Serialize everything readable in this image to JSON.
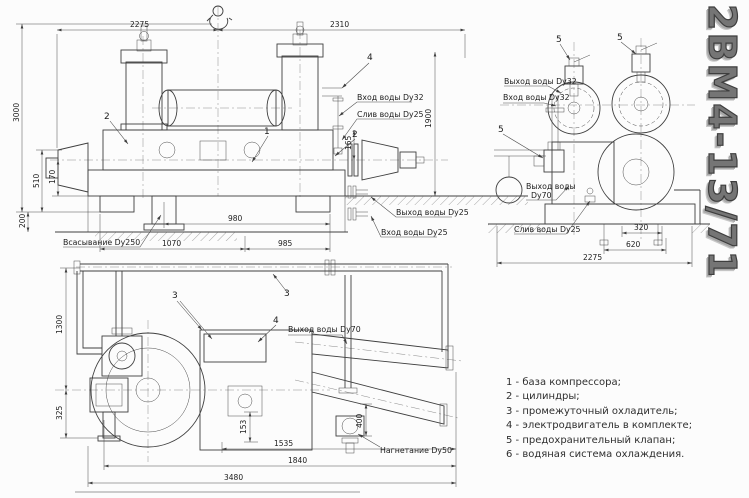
{
  "title": "2ВМ4-13/71",
  "views": {
    "front": {
      "dims": {
        "top_left": "2275",
        "top_right": "2310",
        "height": "3000",
        "left_510": "510",
        "left_170": "170",
        "left_200": "200",
        "right_height": "1900",
        "mid_165": "165",
        "base_980": "980",
        "base_1070": "1070",
        "base_985": "985"
      },
      "labels": {
        "water_in_32": "Вход воды Dy32",
        "water_drain_25": "Слив воды Dy25",
        "water_out_25": "Выход воды Dy25",
        "water_in_25": "Вход воды Dy25",
        "suction": "Всасывание Dy250"
      },
      "callouts": {
        "cylinder_left": "2",
        "base": "1",
        "cylinder_right": "2",
        "upper": "4"
      }
    },
    "side": {
      "dims": {
        "bolt_320": "320",
        "bolt_620": "620",
        "overall_2275": "2275"
      },
      "labels": {
        "water_out_32": "Выход воды Dy32",
        "water_in_32": "Вход воды Dy32",
        "water_out_70_line1": "Выход воды",
        "water_out_70_line2": "Dy70",
        "water_drain_25": "Слив воды Dy25"
      },
      "callouts": {
        "valve_left": "5",
        "valve_right": "5",
        "valve_lower": "5"
      }
    },
    "plan": {
      "dims": {
        "left_1300": "1300",
        "left_325": "325",
        "mid_153": "153",
        "right_400": "400",
        "bottom_1535": "1535",
        "bottom_1840": "1840",
        "bottom_3480": "3480"
      },
      "labels": {
        "water_out_70": "Выход воды Dy70",
        "discharge": "Нагнетание Dy50"
      },
      "callouts": {
        "cooler": "3",
        "pipe": "3",
        "motor": "4"
      }
    }
  },
  "legend": {
    "items": [
      "1 - база компрессора;",
      "2 - цилиндры;",
      "3 - промежуточный охладитель;",
      "4 - электродвигатель в комплекте;",
      "5 - предохранительный клапан;",
      "6 - водяная система охлаждения."
    ]
  }
}
